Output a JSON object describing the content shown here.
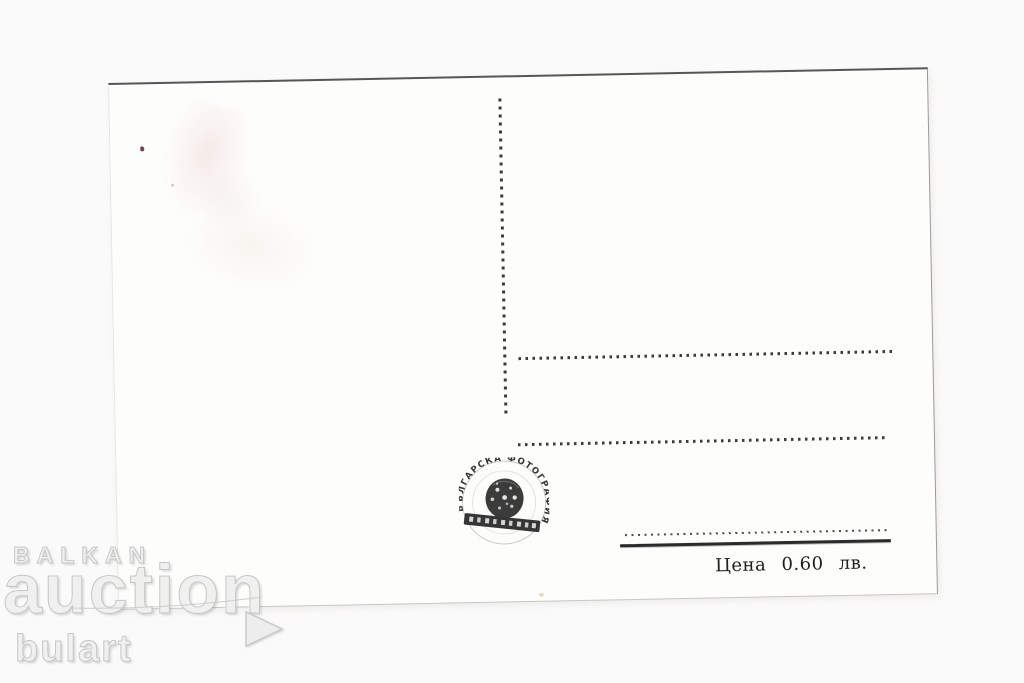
{
  "page": {
    "background": "#fbfafa"
  },
  "watermark": {
    "brand_top": "BALKAN",
    "brand_main": "auction",
    "brand_sub": "bulart",
    "color": "#f0f0f0",
    "outline_color": "#c6c6c6"
  },
  "postcard": {
    "price": "Цена 0.60 лв.",
    "stamp_arc_text": "БЪЛГАРСКА ФОТОГРАФИЯ",
    "ink_color": "#2e2e2e",
    "paper_color": "#fdfdfc",
    "edge_color": "#565656"
  }
}
